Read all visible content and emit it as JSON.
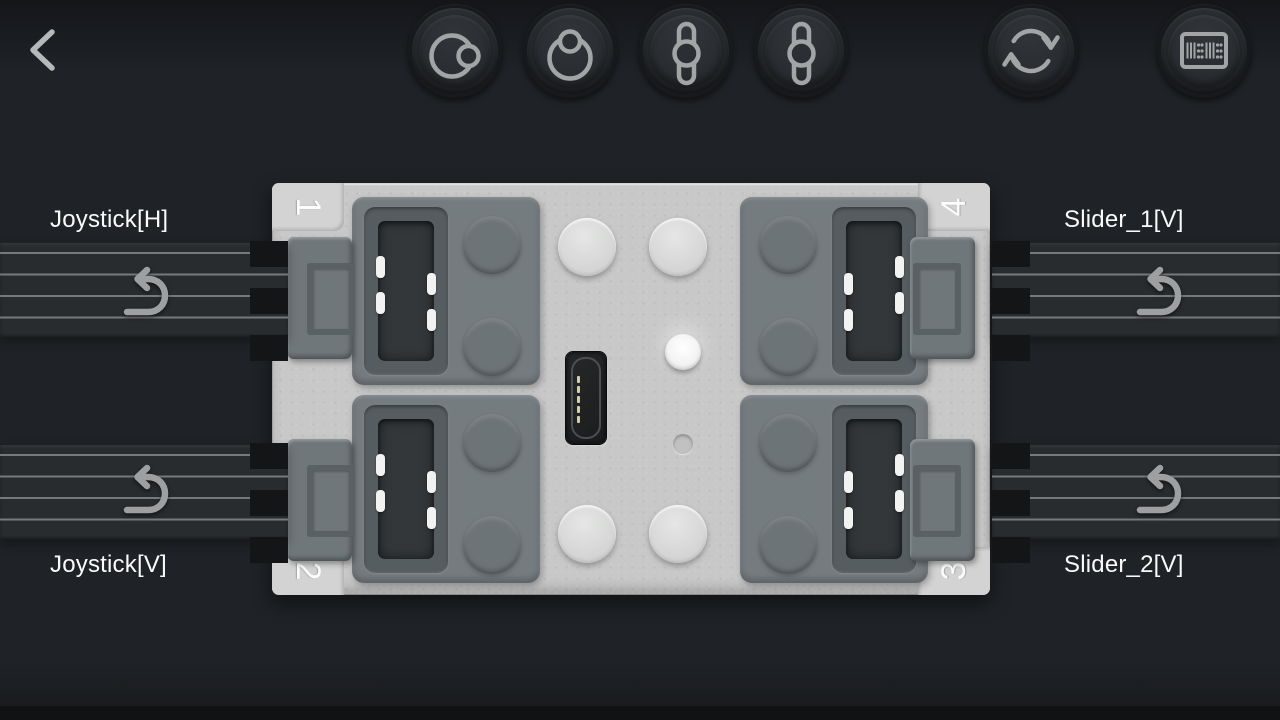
{
  "app": {
    "screen_title": "controller profile port mapping"
  },
  "header": {
    "back": {
      "icon": "back-chevron-icon"
    },
    "toolbar_buttons": [
      {
        "name": "joystick-horizontal",
        "icon": "joystick-horizontal-icon"
      },
      {
        "name": "joystick-vertical",
        "icon": "joystick-vertical-icon"
      },
      {
        "name": "slider-vertical-1",
        "icon": "slider-vertical-icon"
      },
      {
        "name": "slider-vertical-2",
        "icon": "slider-vertical-icon"
      },
      {
        "name": "refresh",
        "icon": "refresh-icon"
      },
      {
        "name": "device",
        "icon": "device-grid-icon"
      }
    ]
  },
  "device": {
    "type": "4-port brick hub",
    "ports": [
      {
        "number": "1",
        "position": "top-left"
      },
      {
        "number": "2",
        "position": "bottom-left"
      },
      {
        "number": "3",
        "position": "bottom-right"
      },
      {
        "number": "4",
        "position": "top-right"
      }
    ],
    "features": [
      "micro-usb-port",
      "led-indicator",
      "reset-dot"
    ]
  },
  "channels": [
    {
      "port": "1",
      "label": "Joystick[H]",
      "side": "left",
      "row": "top",
      "invert_icon": "undo-arrow-icon"
    },
    {
      "port": "2",
      "label": "Joystick[V]",
      "side": "left",
      "row": "bottom",
      "invert_icon": "undo-arrow-icon"
    },
    {
      "port": "4",
      "label": "Slider_1[V]",
      "side": "right",
      "row": "top",
      "invert_icon": "undo-arrow-icon"
    },
    {
      "port": "3",
      "label": "Slider_2[V]",
      "side": "right",
      "row": "bottom",
      "invert_icon": "undo-arrow-icon"
    }
  ],
  "colors": {
    "background": "#1f2226",
    "wire_band": "#292c2f",
    "wire_line": "#84878a",
    "hub_body": "#c7c8c7",
    "port_panel": "#757c80",
    "socket": "#565d61",
    "label_text": "#fafafa",
    "icon_stroke": "#a2a4a6"
  }
}
